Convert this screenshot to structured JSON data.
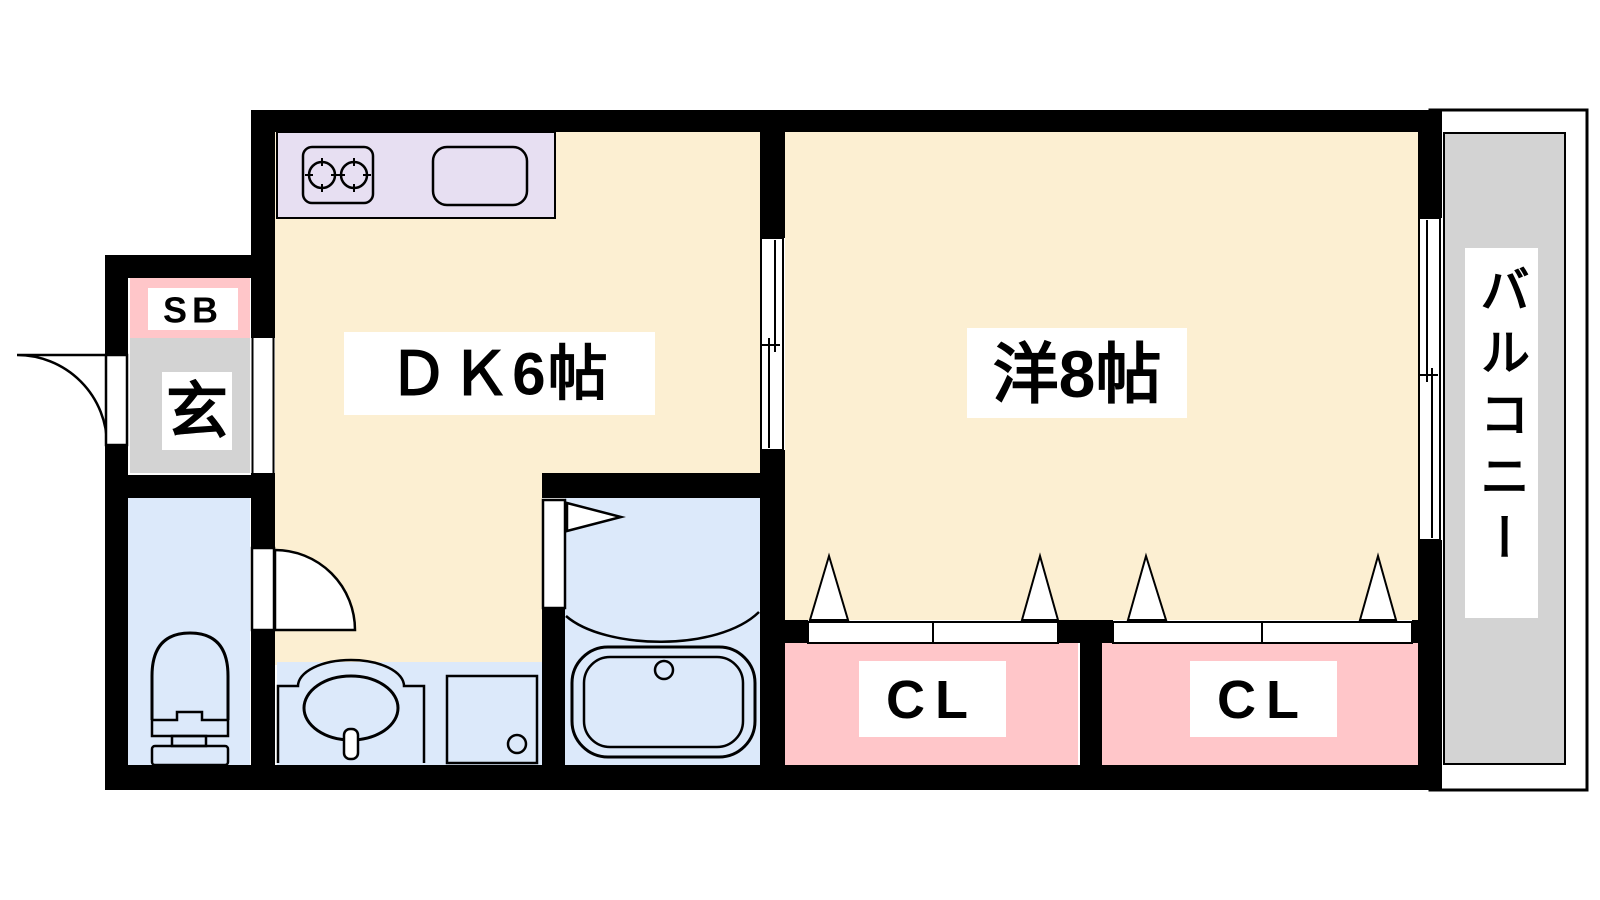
{
  "plan": {
    "type": "apartment-floor-plan",
    "rooms": {
      "dk": {
        "label": "ＤＫ6帖"
      },
      "western_room": {
        "label": "洋8帖"
      },
      "balcony": {
        "label": "バルコニー"
      },
      "genkan": {
        "label": "玄"
      },
      "shoe_box": {
        "label": "SB"
      },
      "closet_left": {
        "label": "CL"
      },
      "closet_right": {
        "label": "CL"
      }
    },
    "colors": {
      "floor": "#FCEFD2",
      "wet_area": "#DCE9FA",
      "closet_pink": "#FFC6C9",
      "gray_area": "#D3D3D3",
      "kitchen_counter": "#E7DFF2",
      "wall": "#000000",
      "line": "#000000",
      "label_bg": "#FFFFFF"
    }
  }
}
